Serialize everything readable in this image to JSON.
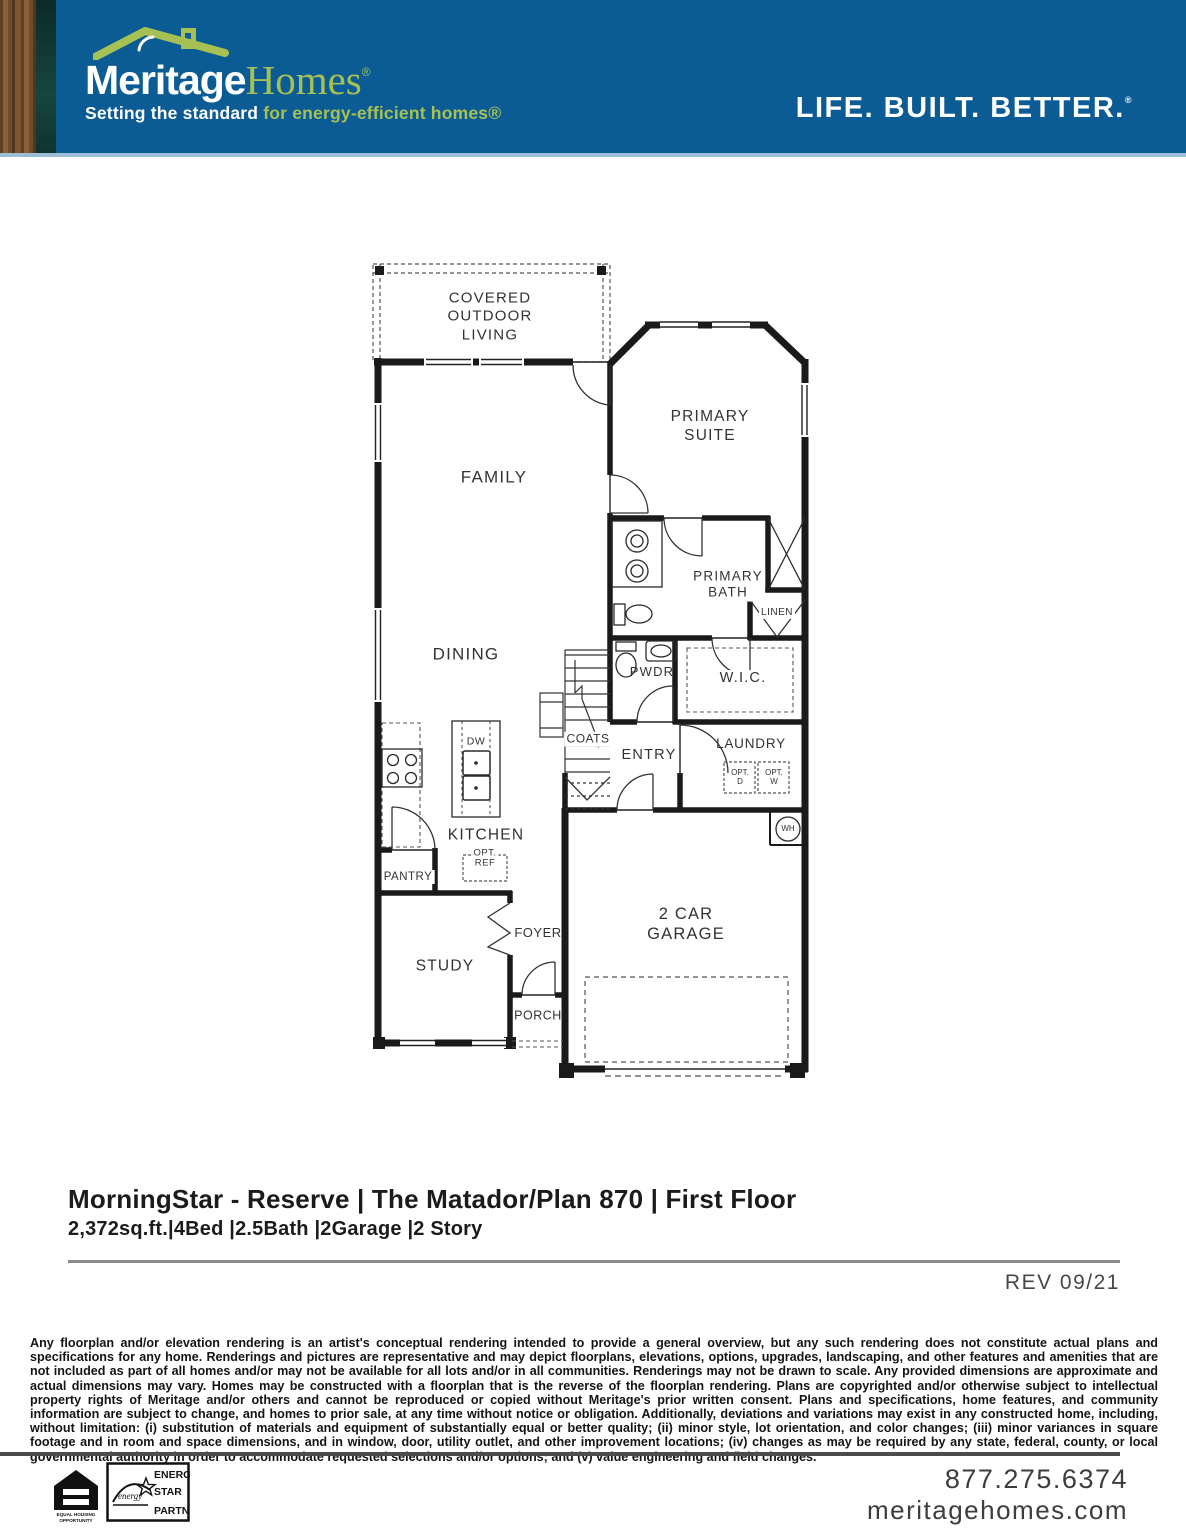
{
  "header": {
    "brand_name_1": "Meritage",
    "brand_name_2": "Homes",
    "brand_reg": "®",
    "tagline_lead": "Setting the standard ",
    "tagline_accent": "for energy-efficient homes®",
    "slogan": "LIFE. BUILT. BETTER.",
    "slogan_mark": "®"
  },
  "plan": {
    "rooms": {
      "covered_outdoor_living": "COVERED\nOUTDOOR\nLIVING",
      "family": "FAMILY",
      "primary_suite": "PRIMARY\nSUITE",
      "primary_bath": "PRIMARY\nBATH",
      "linen": "LINEN",
      "wic": "W.I.C.",
      "pwdr": "PWDR",
      "dining": "DINING",
      "coats": "COATS",
      "entry": "ENTRY",
      "laundry": "LAUNDRY",
      "kitchen": "KITCHEN",
      "pantry": "PANTRY",
      "study": "STUDY",
      "foyer": "FOYER",
      "porch": "PORCH",
      "garage": "2 CAR GARAGE"
    },
    "fixtures": {
      "dw": "DW",
      "wh": "WH",
      "opt_d": "OPT.\nD",
      "opt_w": "OPT.\nW",
      "opt_ref": "OPT.\nREF"
    }
  },
  "title_block": {
    "title": "MorningStar - Reserve | The Matador/Plan 870 | First Floor",
    "specs": "2,372sq.ft.|4Bed |2.5Bath |2Garage |2 Story",
    "revision": "REV 09/21"
  },
  "disclaimer": "Any floorplan and/or elevation rendering is an artist's conceptual rendering intended to provide a general overview, but any such rendering does not constitute actual plans and specifications for any home. Renderings and pictures are representative and may depict floorplans, elevations, options, upgrades, landscaping, and other features and amenities that are not included as part of all homes and/or may not be available for all lots and/or in all communities. Renderings may not be drawn to scale. Any provided dimensions are approximate and actual dimensions may vary. Homes may be constructed with a floorplan that is the reverse of the floorplan rendering. Plans are copyrighted and/or otherwise subject to intellectual property rights of Meritage and/or others and cannot be reproduced or copied without Meritage's prior written consent. Plans and specifications, home features, and community information are subject to change, and homes to prior sale, at any time without notice or obligation. Additionally, deviations and variations may exist in any constructed home, including, without limitation: (i) substitution of materials and equipment of substantially equal or better quality; (ii) minor style, lot orientation, and color changes; (iii) minor variances in square footage and in room and space dimensions, and in window, door, utility outlet, and other improvement locations; (iv) changes as may be required by any state, federal, county, or local governmental authority in order to accommodate requested selections and/or options; and (v) value engineering and field changes.",
  "footer": {
    "phone": "877.275.6374",
    "website": "meritagehomes.com",
    "equal_housing_1": "EQUAL HOUSING",
    "equal_housing_2": "OPPORTUNITY",
    "energy_star": [
      "ENERGY",
      "STAR",
      "PARTNER"
    ]
  },
  "colors": {
    "header_blue": "#0B5C95",
    "brand_green": "#A6C054",
    "wall_ink": "#1a1a1a"
  }
}
